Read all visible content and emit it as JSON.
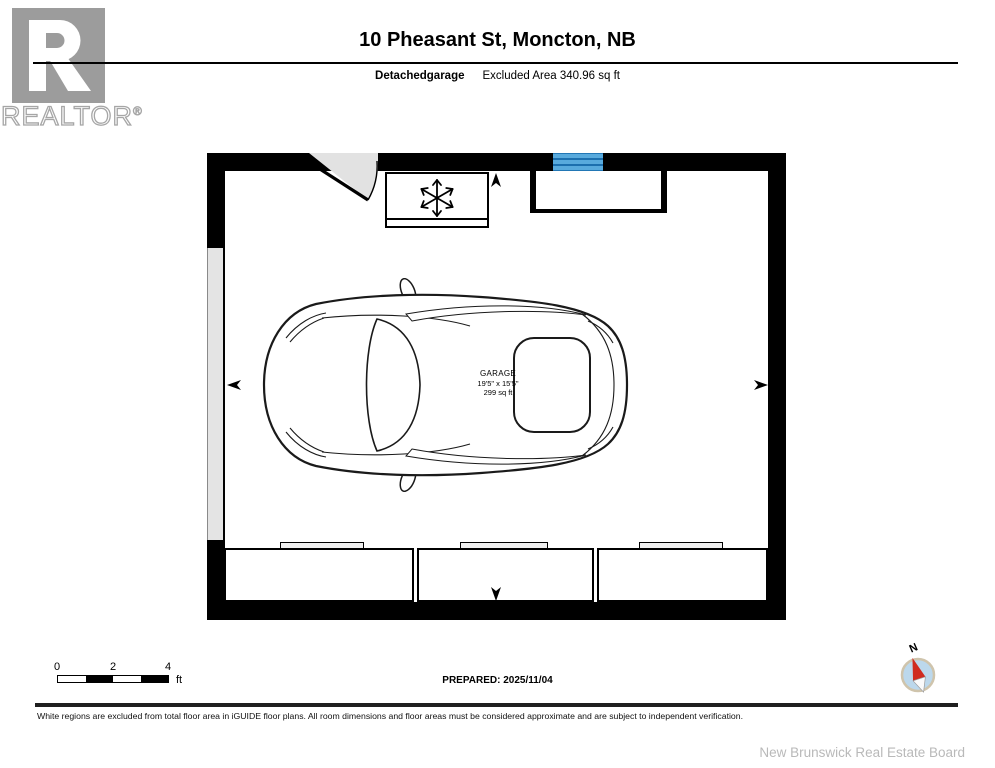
{
  "header": {
    "logo": {
      "letter": "R",
      "brand": "REALTOR",
      "registered": "®"
    },
    "title": "10 Pheasant St, Moncton, NB",
    "floor_label": "Detachedgarage",
    "excluded_area": "Excluded Area 340.96 sq ft"
  },
  "floor_plan": {
    "room": {
      "name": "GARAGE",
      "dimensions": "19'5\" x 15'5\"",
      "area": "299 sq ft"
    },
    "colors": {
      "wall": "#000000",
      "window_blue": "#58aadd",
      "window_line_blue": "#1c6fae",
      "door_swing_gray": "#e2e2e2",
      "garage_door_gray": "#e4e4e4"
    }
  },
  "scale_bar": {
    "ticks": [
      "0",
      "2",
      "4"
    ],
    "unit": "ft"
  },
  "prepared_label": "PREPARED: 2025/11/04",
  "compass": {
    "label": "N",
    "needle_red": "#d02b20",
    "dial_blue": "#bcd8ec",
    "ring_tan": "#cfc4ac"
  },
  "footer": {
    "disclaimer": "White regions are excluded from total floor area in iGUIDE floor plans. All room dimensions and floor areas must be considered approximate and are subject to independent verification.",
    "attribution": "New Brunswick Real Estate Board"
  },
  "branding": {
    "logo_gray": "#9c9c9c"
  }
}
